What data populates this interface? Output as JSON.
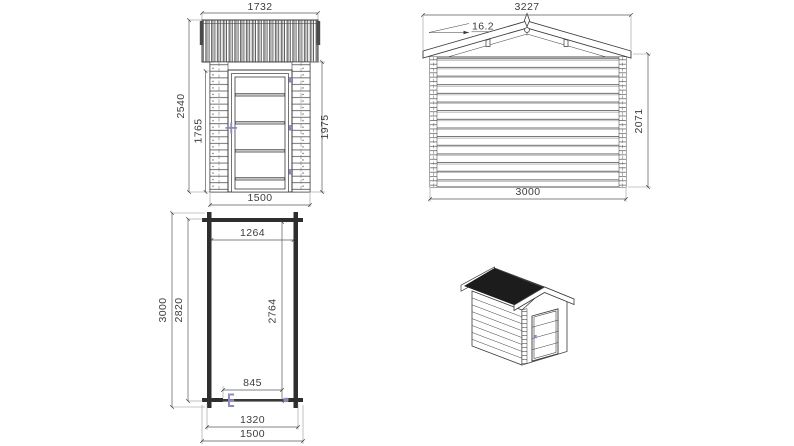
{
  "drawing": {
    "title": "Log cabin shed technical drawing",
    "colors": {
      "line": "#3a3a3a",
      "dim_text": "#3d3d3d",
      "accent": "#8a8cc0",
      "roof_dark": "#1c1c1c",
      "plank_gray": "#a8a8a8"
    },
    "front_elevation": {
      "view_label": "front elevation",
      "width_overall": "1732",
      "height_overall": "2540",
      "door_height": "1765",
      "wall_height": "1975",
      "width_wall": "1500"
    },
    "side_elevation": {
      "view_label": "side elevation",
      "roof_width": "3227",
      "roof_angle": "16.2",
      "wall_height": "2071",
      "wall_width": "3000"
    },
    "floor_plan": {
      "view_label": "floor plan",
      "inner_width": "1264",
      "depth_overall": "3000",
      "depth_wall": "2820",
      "depth_inner": "2764",
      "door_opening": "845",
      "width_wall": "1320",
      "width_overall": "1500"
    },
    "isometric": {
      "view_label": "3d perspective view"
    }
  }
}
